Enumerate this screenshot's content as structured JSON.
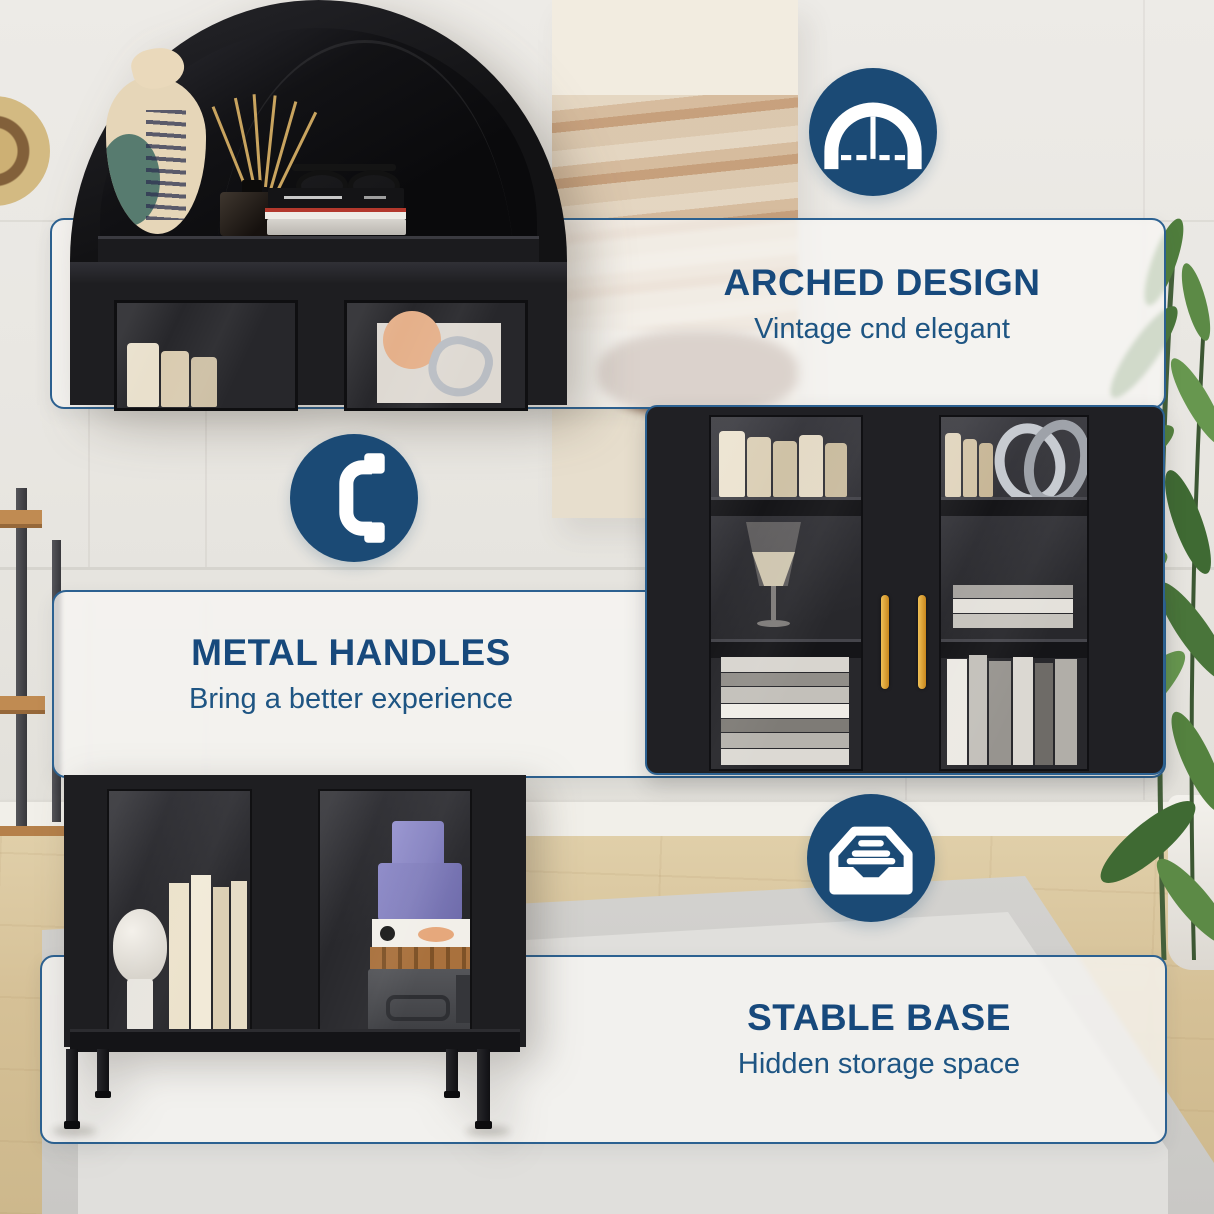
{
  "canvas": {
    "width": 1214,
    "height": 1214
  },
  "palette": {
    "brand_blue": "#1b4a75",
    "heading_blue": "#17497c",
    "subtitle_blue": "#1e5583",
    "card_border": "#2c6191",
    "card_fill": "rgba(247,246,243,0.78)",
    "cabinet_black": "#1e1e21",
    "handle_gold": "#c8871d",
    "wall": "#e9e7e2",
    "floor_wood": "#e0cfa9",
    "rug_outer": "#d3d2cf",
    "rug_inner": "#e0dfdc",
    "plant_green": "#5c8a46",
    "pot_white": "#f3f1ec",
    "icon_glyph": "#ffffff"
  },
  "features": [
    {
      "id": "arched-design",
      "icon": "arch-icon",
      "title": "ARCHED DESIGN",
      "subtitle": "Vintage cnd elegant"
    },
    {
      "id": "metal-handles",
      "icon": "handle-icon",
      "title": "METAL HANDLES",
      "subtitle": "Bring a better experience"
    },
    {
      "id": "stable-base",
      "icon": "drawer-icon",
      "title": "STABLE BASE",
      "subtitle": "Hidden storage space"
    }
  ],
  "photos": [
    {
      "id": "arch-top",
      "alt": "Arched cabinet top shelf with decorative bag vase, reed diffuser, stacked books and glasses"
    },
    {
      "id": "middle-doors",
      "alt": "Black glass cabinet doors with gold metal handles, shelves styled with books, goblet and sculpture"
    },
    {
      "id": "bottom-base",
      "alt": "Cabinet base with glass doors, metal legs, dome lamp, cream books, purple boxes and storage box"
    }
  ]
}
